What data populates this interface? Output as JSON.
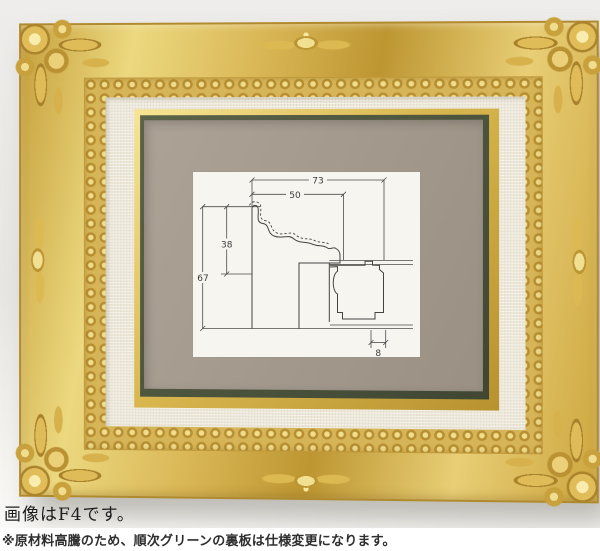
{
  "photo": {
    "subject": "gold ornate baroque picture frame with linen liner and green inner edge, empty taupe backing board",
    "colors": {
      "gold": "#d4b14c",
      "gold_highlight": "#f2e193",
      "gold_shadow": "#a8842c",
      "liner_cream": "#ece7d8",
      "green_inner_line": "#47503a",
      "backing_taupe": "#a2988c",
      "wall_background": "#eeedeb"
    }
  },
  "diagram": {
    "labels": {
      "total_width": "73",
      "face_width": "50",
      "front_height": "38",
      "total_height": "67",
      "lip_width": "8"
    }
  },
  "captions": {
    "image_note": "画像はF4です。",
    "notice": "※原材料高騰のため、順次グリーンの裏板は仕様変更になります。"
  }
}
